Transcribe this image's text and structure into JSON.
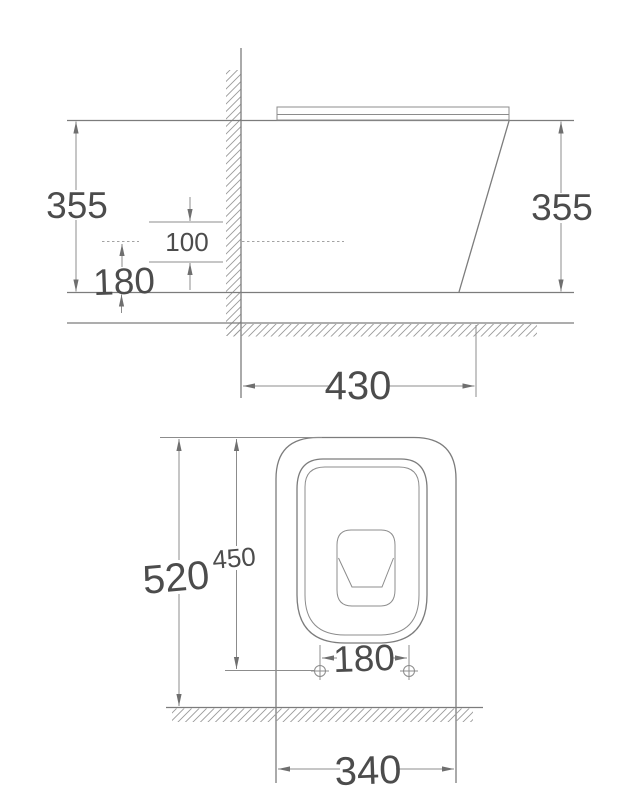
{
  "colors": {
    "background": "#ffffff",
    "outline_line": "#7c7c7c",
    "dimension_line": "#8c8c8c",
    "dimension_text": "#4c4c4c",
    "hatch": "#9a9a9a"
  },
  "side_view": {
    "height_left": "355",
    "height_right": "355",
    "offset_upper": "100",
    "offset_lower": "180",
    "depth_from_wall": "430"
  },
  "plan_view": {
    "depth_overall": "520",
    "depth_to_holes": "450",
    "hole_spacing": "180",
    "width_overall": "340"
  }
}
